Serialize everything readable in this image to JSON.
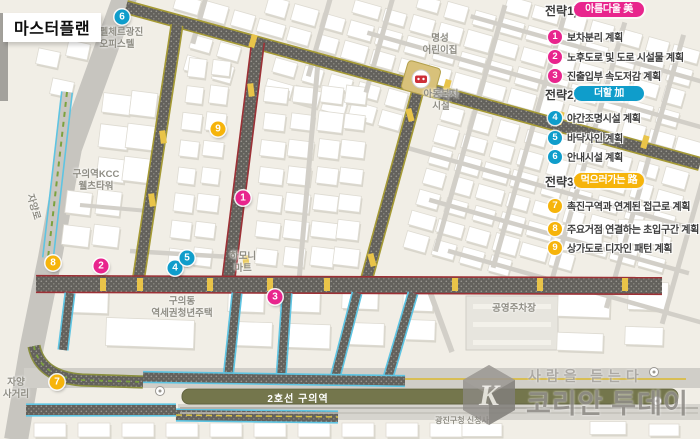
{
  "title": "마스터플랜",
  "legend": {
    "strategies": [
      {
        "label": "전략1)",
        "pill": "아름다울 美",
        "color": "#e8258d",
        "items": [
          {
            "num": "1",
            "text": "보차분리 계획"
          },
          {
            "num": "2",
            "text": "노후도로 및 도로 시설물 계획"
          },
          {
            "num": "3",
            "text": "진출입부 속도저감 계획"
          }
        ]
      },
      {
        "label": "전략2)",
        "pill": "더할 加",
        "color": "#0f9dcb",
        "items": [
          {
            "num": "4",
            "text": "야간조명시설 계획"
          },
          {
            "num": "5",
            "text": "바닥사인 계획"
          },
          {
            "num": "6",
            "text": "안내시설 계획"
          }
        ]
      },
      {
        "label": "전략3)",
        "pill": "먹으러가는 路",
        "color": "#f6b40b",
        "items": [
          {
            "num": "7",
            "text": "촉진구역과 연계된 접근로 계획"
          },
          {
            "num": "8",
            "text": "주요거점 연결하는 초입구간 계획"
          },
          {
            "num": "9",
            "text": "상가도로 디자인 패턴 계획"
          }
        ]
      }
    ]
  },
  "map": {
    "station_label": "2호선 구의역",
    "labels": [
      {
        "text": "아펠체르광진\n오피스텔",
        "x": 117,
        "y": 27
      },
      {
        "text": "명성\n어린이집",
        "x": 440,
        "y": 33
      },
      {
        "text": "아동복지\n시설",
        "x": 441,
        "y": 89
      },
      {
        "text": "구의역KCC\n웰츠타워",
        "x": 96,
        "y": 169
      },
      {
        "text": "하모니\n마트",
        "x": 243,
        "y": 251
      },
      {
        "text": "구의동\n역세권청년주택",
        "x": 182,
        "y": 296
      },
      {
        "text": "공영주차장",
        "x": 514,
        "y": 303
      },
      {
        "text": "자양\n사거리",
        "x": 16,
        "y": 377
      },
      {
        "text": "광진구청 신청사",
        "x": 462,
        "y": 416,
        "size": 8
      },
      {
        "text": "자양로",
        "x": 33,
        "y": 207,
        "rotate": 74
      }
    ],
    "markers": [
      {
        "num": "1",
        "x": 243,
        "y": 198,
        "strategy": 0
      },
      {
        "num": "2",
        "x": 101,
        "y": 266,
        "strategy": 0
      },
      {
        "num": "3",
        "x": 275,
        "y": 297,
        "strategy": 0
      },
      {
        "num": "4",
        "x": 175,
        "y": 268,
        "strategy": 1
      },
      {
        "num": "5",
        "x": 187,
        "y": 258,
        "strategy": 1
      },
      {
        "num": "6",
        "x": 122,
        "y": 17,
        "strategy": 1
      },
      {
        "num": "7",
        "x": 57,
        "y": 382,
        "strategy": 2
      },
      {
        "num": "8",
        "x": 53,
        "y": 263,
        "strategy": 2
      },
      {
        "num": "9",
        "x": 218,
        "y": 129,
        "strategy": 2
      }
    ]
  },
  "watermark": {
    "tagline": "사람을 듣는다",
    "brand": "코리안 투데이",
    "logo_letter": "K"
  },
  "colors": {
    "strategy1": "#e8258d",
    "strategy2": "#0f9dcb",
    "strategy3": "#f6b40b",
    "road_red": "#9c3136",
    "road_olive": "#a59a35",
    "road_cyan": "#5ec4e2",
    "crossing_yellow": "#e9c449",
    "station_bar": "#74764c"
  }
}
